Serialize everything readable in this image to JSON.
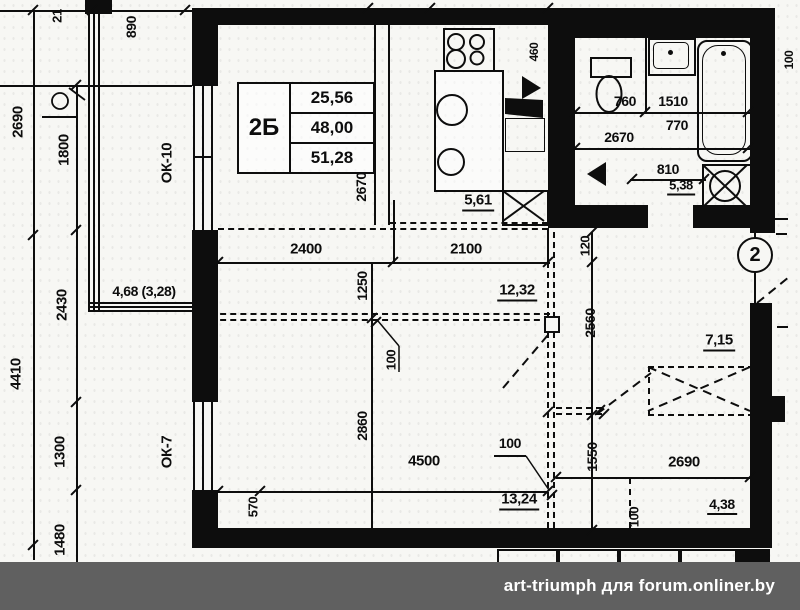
{
  "colors": {
    "line": "#0d0d0d",
    "paper": "#f7f7f4",
    "watermark_bg": "#606060",
    "watermark_text": "#ffffff"
  },
  "apartment_table": {
    "type": "2Б",
    "rows": [
      "25,56",
      "48,00",
      "51,28"
    ]
  },
  "axis": {
    "number": "2"
  },
  "watermark": {
    "text": "art-triumph для forum.onliner.by"
  },
  "dims": {
    "t21": "21",
    "t890": "890",
    "l2690": "2690",
    "l1800": "1800",
    "l2430": "2430",
    "l4410": "4410",
    "l1300": "1300",
    "l1480": "1480",
    "ok10": "ОК-10",
    "ok7": "ОК-7",
    "balcony_area": "4,68 (3,28)",
    "k2670": "2670",
    "kitchen_area": "5,61",
    "d460": "460",
    "b760": "760",
    "b1510": "1510",
    "b2670": "2670",
    "b770": "770",
    "b810": "810",
    "bath_area": "5,38",
    "r100top": "100",
    "d2400": "2400",
    "d2100": "2100",
    "d1250": "1250",
    "room_area_upper": "12,32",
    "r120": "120",
    "r2560": "2560",
    "p100a": "100",
    "d2860": "2860",
    "d4500": "4500",
    "p100b": "100",
    "room_area_lower": "13,24",
    "d570": "570",
    "hall_area": "7,15",
    "r1550": "1550",
    "d2690b": "2690",
    "hall_area2": "4,38",
    "p100c": "100"
  }
}
